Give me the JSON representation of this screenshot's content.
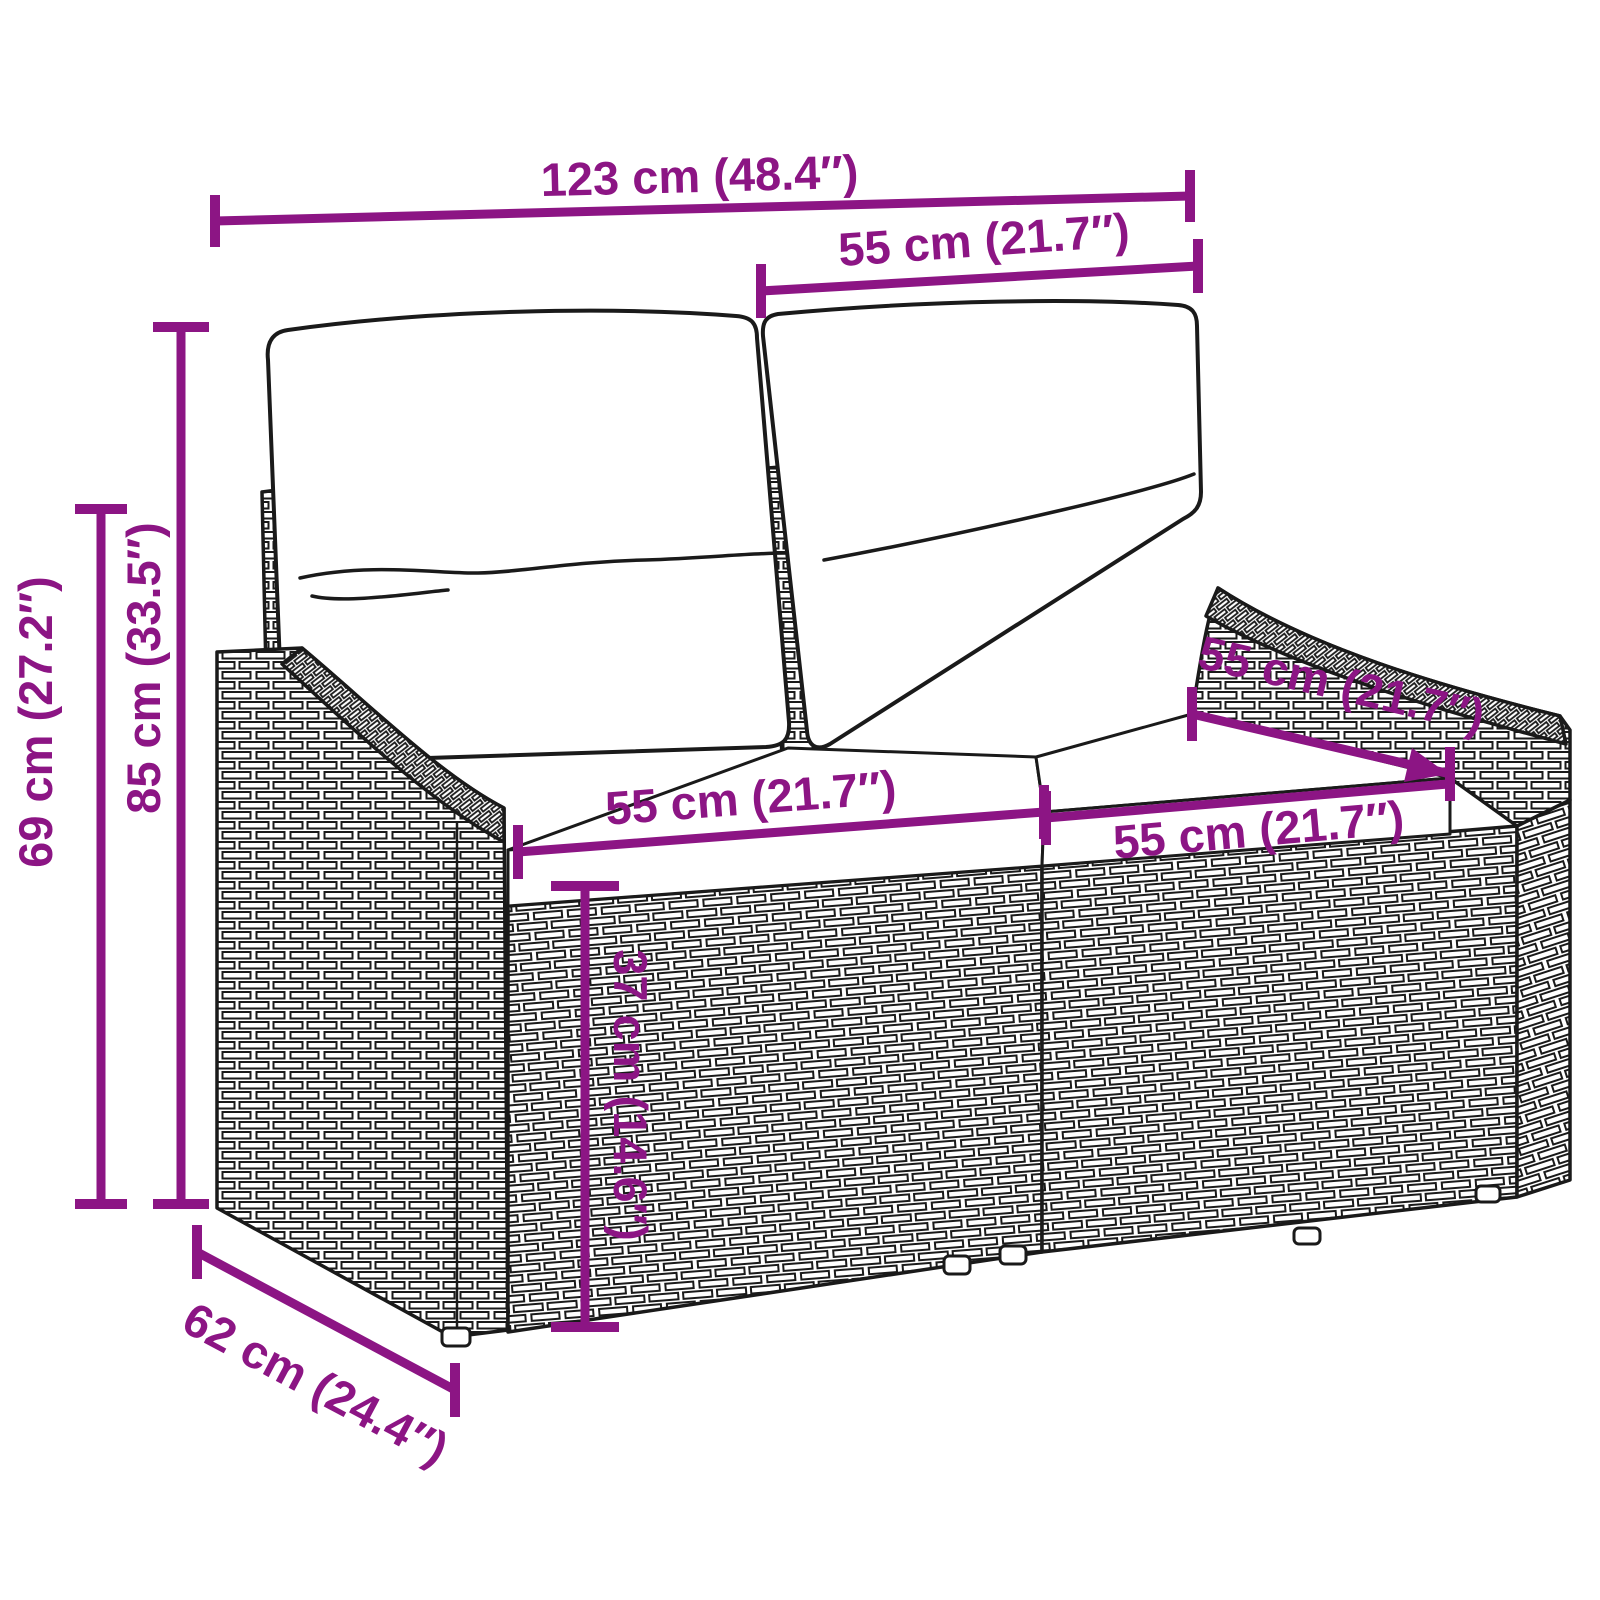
{
  "colors": {
    "dimension": "#8C1584",
    "outline": "#1a1a1a",
    "background": "#ffffff"
  },
  "product": {
    "kind": "garden-sofa-2-seater-with-cushions"
  },
  "dimensions": {
    "overall_width": "123 cm (48.4″)",
    "backrest_width": "55 cm (21.7″)",
    "overall_height": "85 cm (33.5″)",
    "base_height": "69 cm (27.2″)",
    "seat_width_left": "55 cm (21.7″)",
    "seat_depth": "55 cm (21.7″)",
    "seat_width_right": "55 cm (21.7″)",
    "seat_height": "37 cm (14.6″)",
    "overall_depth": "62 cm (24.4″)"
  }
}
